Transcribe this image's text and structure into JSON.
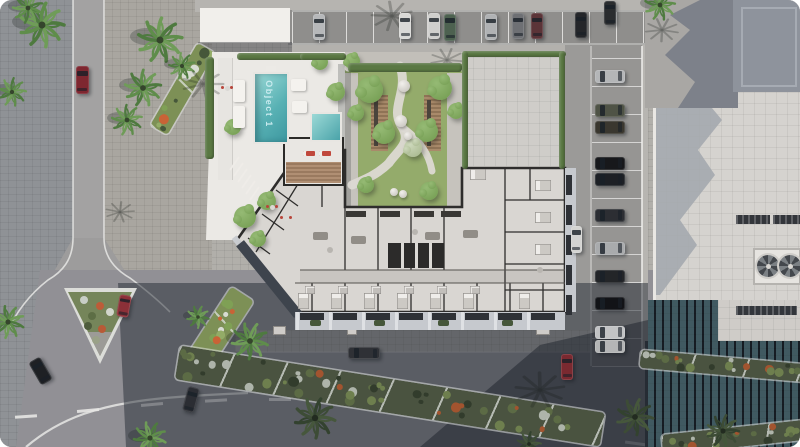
{
  "labels": {
    "pool": "Object 1"
  },
  "palette": {
    "ground": "#b1afaa",
    "plaza_blue": "#8f9296",
    "plaza_warm": "#a9a6a0",
    "road_top": "#8f8e8c",
    "road_light": "#a3a2a2",
    "asphalt": "#919095",
    "sidewalk": "#b3b1ad",
    "terrace": "#ebe9e5",
    "pool_light": "#9bd9d6",
    "pool_deep": "#3e98a0",
    "lawn": "#94ab6b",
    "path": "#dcd9d3",
    "hedge": "#5a7843",
    "floor": "#d9d6d2",
    "corridor": "#c8c5c1",
    "wall": "#2e2d2c",
    "facade": "#c6c9ce",
    "window_slot": "#2e3136",
    "wood": "#a98a6a",
    "right_wall": "#a9a7a4",
    "right_shadow": "#7d818a",
    "roof_blue": "#8e939c",
    "roof_white": "#d5d3cf",
    "glass_dark": "#2b333d",
    "glass_cell": "#446067",
    "shadow_main": "rgba(36,41,52,0.5)",
    "shadow_deep": "rgba(15,20,30,0.4)",
    "marking": "#e8e8e6"
  },
  "scene": {
    "stalls": {
      "top": {
        "x0": 292,
        "x1": 645,
        "y": 12,
        "h": 31,
        "step": 27
      },
      "right": {
        "y0": 58,
        "y1": 366,
        "x": 592,
        "w": 50,
        "step": 28
      }
    },
    "dashes": [
      [
        26,
        416,
        -4
      ],
      [
        88,
        410,
        -5
      ],
      [
        152,
        404,
        -5
      ],
      [
        216,
        400,
        -3
      ],
      [
        280,
        399,
        0
      ],
      [
        344,
        400,
        2
      ],
      [
        410,
        403,
        4
      ],
      [
        474,
        407,
        5
      ],
      [
        536,
        412,
        7
      ],
      [
        578,
        438,
        10
      ],
      [
        636,
        443,
        8
      ]
    ],
    "cars": [
      [
        319,
        27,
        12,
        26,
        0,
        "#b6b8ba"
      ],
      [
        405,
        26,
        12,
        26,
        0,
        "#d9d9d7"
      ],
      [
        434,
        26,
        12,
        26,
        0,
        "#cfcfcd"
      ],
      [
        450,
        27,
        12,
        27,
        0,
        "#4d6150"
      ],
      [
        491,
        27,
        12,
        26,
        0,
        "#b0b2b4"
      ],
      [
        518,
        26,
        12,
        26,
        0,
        "#6e7074"
      ],
      [
        537,
        26,
        12,
        26,
        0,
        "#5b3438"
      ],
      [
        581,
        25,
        12,
        26,
        0,
        "#24262a"
      ],
      [
        610,
        13,
        12,
        24,
        0,
        "#2a2c2e"
      ],
      [
        610,
        76,
        30,
        13,
        0,
        "#b4b6b8"
      ],
      [
        610,
        110,
        30,
        13,
        0,
        "#4f5346"
      ],
      [
        610,
        127,
        30,
        13,
        0,
        "#3a372f"
      ],
      [
        610,
        163,
        30,
        13,
        0,
        "#17181b"
      ],
      [
        610,
        179,
        30,
        13,
        0,
        "#1d2025"
      ],
      [
        610,
        215,
        30,
        13,
        0,
        "#2c2e33"
      ],
      [
        610,
        248,
        30,
        13,
        0,
        "#a9abad"
      ],
      [
        610,
        276,
        30,
        13,
        0,
        "#232528"
      ],
      [
        610,
        303,
        30,
        13,
        0,
        "#121317"
      ],
      [
        610,
        332,
        30,
        13,
        0,
        "#c2c3c5"
      ],
      [
        610,
        346,
        30,
        13,
        0,
        "#b4b5b6"
      ],
      [
        82,
        80,
        13,
        28,
        0,
        "#7e2730"
      ],
      [
        124,
        306,
        12,
        22,
        10,
        "#8c3038"
      ],
      [
        40,
        371,
        13,
        26,
        -30,
        "#1e2024"
      ],
      [
        191,
        399,
        12,
        25,
        15,
        "#2b2d33"
      ],
      [
        364,
        353,
        32,
        12,
        0,
        "#2f3136"
      ],
      [
        567,
        367,
        12,
        26,
        0,
        "#7a2930"
      ],
      [
        576,
        239,
        11,
        27,
        0,
        "#d4d4d2"
      ]
    ],
    "palms": [
      [
        42,
        25,
        22,
        0
      ],
      [
        12,
        92,
        14,
        0
      ],
      [
        160,
        40,
        22,
        0
      ],
      [
        143,
        88,
        18,
        0
      ],
      [
        127,
        120,
        15,
        0
      ],
      [
        182,
        66,
        13,
        0
      ],
      [
        28,
        8,
        15,
        0
      ],
      [
        8,
        322,
        16,
        0
      ],
      [
        150,
        438,
        16,
        0
      ],
      [
        250,
        341,
        18,
        0
      ],
      [
        198,
        317,
        11,
        0
      ],
      [
        315,
        418,
        20,
        1
      ],
      [
        635,
        417,
        18,
        1
      ],
      [
        723,
        431,
        16,
        1
      ],
      [
        529,
        444,
        12,
        1
      ],
      [
        660,
        5,
        15,
        0
      ]
    ],
    "shadow_palms": [
      [
        203,
        84,
        20
      ],
      [
        392,
        16,
        20
      ],
      [
        447,
        60,
        16
      ],
      [
        540,
        390,
        24
      ],
      [
        662,
        30,
        16
      ],
      [
        120,
        212,
        14
      ]
    ],
    "trees": [
      [
        267,
        201,
        9,
        0
      ],
      [
        245,
        217,
        11,
        0
      ],
      [
        258,
        239,
        8,
        0
      ],
      [
        233,
        127,
        8,
        0
      ],
      [
        320,
        62,
        8,
        0
      ],
      [
        336,
        92,
        9,
        0
      ],
      [
        370,
        90,
        13,
        0
      ],
      [
        440,
        88,
        12,
        0
      ],
      [
        384,
        133,
        11,
        0
      ],
      [
        427,
        131,
        11,
        0
      ],
      [
        456,
        111,
        8,
        0
      ],
      [
        356,
        113,
        8,
        0
      ],
      [
        413,
        148,
        9,
        1
      ],
      [
        429,
        191,
        9,
        0
      ],
      [
        366,
        185,
        8,
        0
      ],
      [
        352,
        61,
        8,
        0
      ]
    ],
    "boulders": [
      [
        404,
        86,
        6
      ],
      [
        401,
        121,
        6
      ],
      [
        408,
        136,
        4
      ],
      [
        394,
        192,
        4
      ],
      [
        403,
        194,
        4
      ]
    ],
    "beds": [
      [
        182,
        89,
        95,
        20,
        -60,
        1
      ],
      [
        219,
        329,
        85,
        27,
        -57,
        1
      ],
      [
        390,
        396,
        430,
        34,
        9,
        0
      ],
      [
        722,
        366,
        165,
        18,
        5,
        0
      ],
      [
        737,
        437,
        150,
        20,
        -6,
        0
      ]
    ],
    "island": {
      "outer": "64px 288px, 137px 288px, 100px 364px",
      "inner": "68px 292px, 132px 292px, 100px 356px",
      "dots": [
        [
          84,
          300,
          "#c8cec6"
        ],
        [
          100,
          306,
          "#bd5c38"
        ],
        [
          92,
          316,
          "#5d6e45"
        ],
        [
          110,
          312,
          "#d2d6cc"
        ],
        [
          88,
          326,
          "#4e5c3c"
        ],
        [
          102,
          329,
          "#b85a36"
        ],
        [
          96,
          340,
          "#9aa188"
        ]
      ]
    },
    "hedges": [
      [
        237,
        53,
        108,
        7
      ],
      [
        300,
        53,
        46,
        7
      ],
      [
        348,
        63,
        114,
        9
      ],
      [
        462,
        51,
        104,
        6
      ],
      [
        462,
        51,
        6,
        118
      ],
      [
        559,
        51,
        6,
        118
      ],
      [
        205,
        57,
        9,
        102
      ]
    ],
    "planters": [
      [
        310,
        320
      ],
      [
        374,
        320
      ],
      [
        438,
        320
      ],
      [
        502,
        320
      ]
    ],
    "util": [
      [
        273,
        326,
        13,
        9
      ],
      [
        347,
        328,
        10,
        7
      ],
      [
        536,
        327,
        14,
        8
      ]
    ],
    "furnishings": [
      [
        272,
        207
      ],
      [
        286,
        218
      ],
      [
        227,
        88
      ]
    ],
    "loungers": {
      "left": [
        [
          239,
          80
        ],
        [
          239,
          106
        ]
      ],
      "day": [
        [
          291,
          79
        ],
        [
          292,
          101
        ]
      ],
      "deck_red": [
        [
          303,
          151
        ],
        [
          319,
          151
        ]
      ]
    },
    "vents": [
      [
        736,
        215,
        34,
        9
      ],
      [
        773,
        215,
        27,
        9
      ],
      [
        736,
        306,
        61,
        9
      ]
    ],
    "fans": {
      "frame": [
        753,
        248,
        48,
        37
      ],
      "circles": [
        [
          768,
          266,
          11
        ],
        [
          790,
          266,
          11
        ]
      ]
    },
    "steps": [
      [
        230,
        170,
        239,
        157
      ],
      [
        234,
        176,
        243,
        163
      ],
      [
        238,
        182,
        247,
        169
      ],
      [
        242,
        188,
        251,
        175
      ],
      [
        246,
        194,
        255,
        181
      ],
      [
        250,
        200,
        259,
        187
      ]
    ],
    "walls": {
      "outer": "M300,150 L345,150 L345,207 L462,207 L462,168 L565,168 L565,312 L295,312 L237,240 Z",
      "vl": [
        312,
        345,
        378,
        411,
        444,
        477,
        510,
        543
      ],
      "vu": [
        345,
        378,
        411,
        444
      ],
      "eh": [
        200,
        232,
        264,
        290
      ],
      "misc": [
        [
          505,
          168,
          505,
          312
        ],
        [
          530,
          168,
          530,
          200
        ],
        [
          322,
          150,
          322,
          207
        ],
        [
          300,
          178,
          345,
          178
        ],
        [
          256,
          252,
          314,
          158
        ],
        [
          248,
          238,
          270,
          254
        ],
        [
          262,
          214,
          284,
          230
        ],
        [
          276,
          190,
          298,
          206
        ]
      ],
      "corridor": [
        [
          300,
          270,
          565,
          270
        ],
        [
          295,
          283,
          565,
          283
        ]
      ]
    },
    "furniture": {
      "beds": [
        [
          303,
          293
        ],
        [
          336,
          293
        ],
        [
          369,
          293
        ],
        [
          402,
          293
        ],
        [
          435,
          293
        ],
        [
          468,
          293
        ],
        [
          524,
          293
        ]
      ],
      "ebeds": [
        [
          543,
          185
        ],
        [
          543,
          217
        ],
        [
          543,
          249
        ],
        [
          478,
          174
        ]
      ],
      "kitchens": [
        [
          356,
          211
        ],
        [
          390,
          211
        ],
        [
          424,
          211
        ],
        [
          451,
          211
        ]
      ],
      "sofas": [
        [
          320,
          232
        ],
        [
          358,
          236
        ],
        [
          432,
          232
        ],
        [
          470,
          230
        ]
      ],
      "baths": [
        [
          310,
          286
        ],
        [
          343,
          286
        ],
        [
          376,
          286
        ],
        [
          409,
          286
        ],
        [
          442,
          286
        ],
        [
          475,
          286
        ]
      ],
      "tables": [
        [
          330,
          250
        ],
        [
          415,
          232
        ],
        [
          540,
          270
        ]
      ],
      "core": [
        388,
        243,
        56,
        25
      ]
    }
  }
}
